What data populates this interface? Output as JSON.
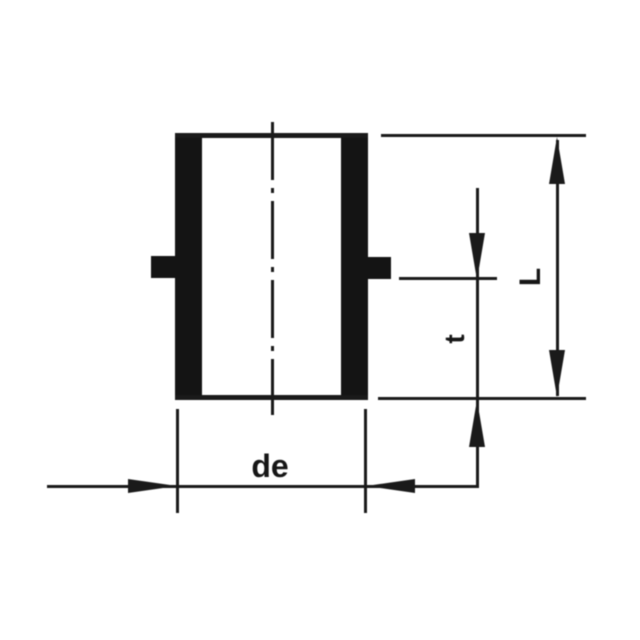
{
  "figure": {
    "background_color": "#ffffff",
    "line_color": "#1a1a1a",
    "fill_color": "#141414"
  },
  "dimensions": {
    "outer_diameter": {
      "label": "de"
    },
    "socket_depth": {
      "label": "t"
    },
    "overall_length": {
      "label": "L"
    }
  }
}
